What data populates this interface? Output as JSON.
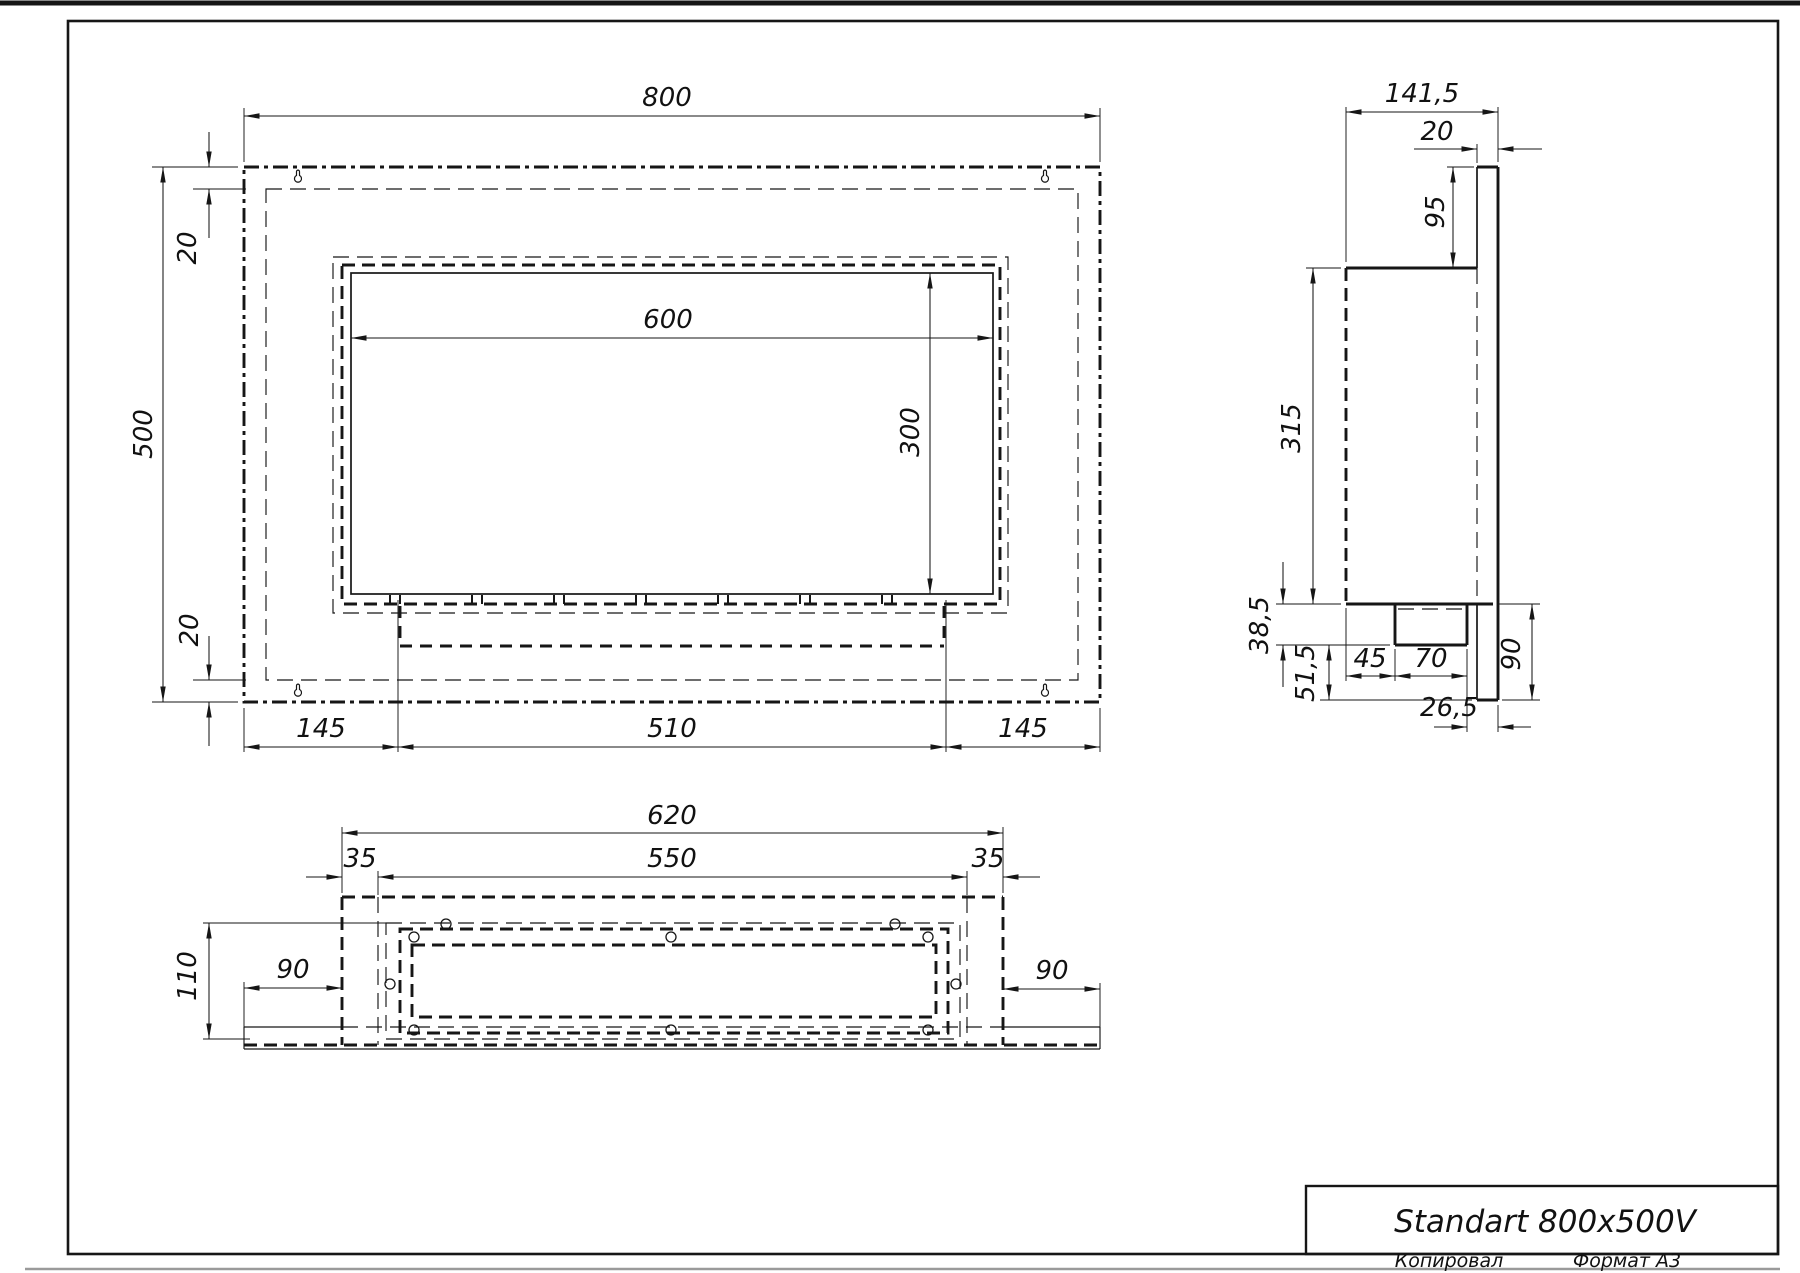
{
  "front": {
    "width": "800",
    "height": "500",
    "opening_width": "600",
    "opening_height": "300",
    "top_margin": "20",
    "bottom_margin": "20",
    "bottom_left": "145",
    "bottom_center": "510",
    "bottom_right": "145"
  },
  "side": {
    "depth": "141,5",
    "plate_thickness": "20",
    "top_offset": "95",
    "body_height": "315",
    "tray_height": "38,5",
    "bottom_gap": "51,5",
    "tray_setback": "45",
    "tray_depth": "70",
    "tray_lip": "26,5",
    "lower_height": "90"
  },
  "bottom": {
    "outer_width": "620",
    "inner_width": "550",
    "left_margin": "35",
    "right_margin": "35",
    "depth": "110",
    "left_wing": "90",
    "right_wing": "90"
  },
  "title_block": {
    "title": "Standart 800x500V",
    "copied": "Копировал",
    "format": "Формат А3"
  },
  "icons": {
    "mounting_hole": "keyhole-icon",
    "screw_hole": "screw-hole-icon"
  }
}
